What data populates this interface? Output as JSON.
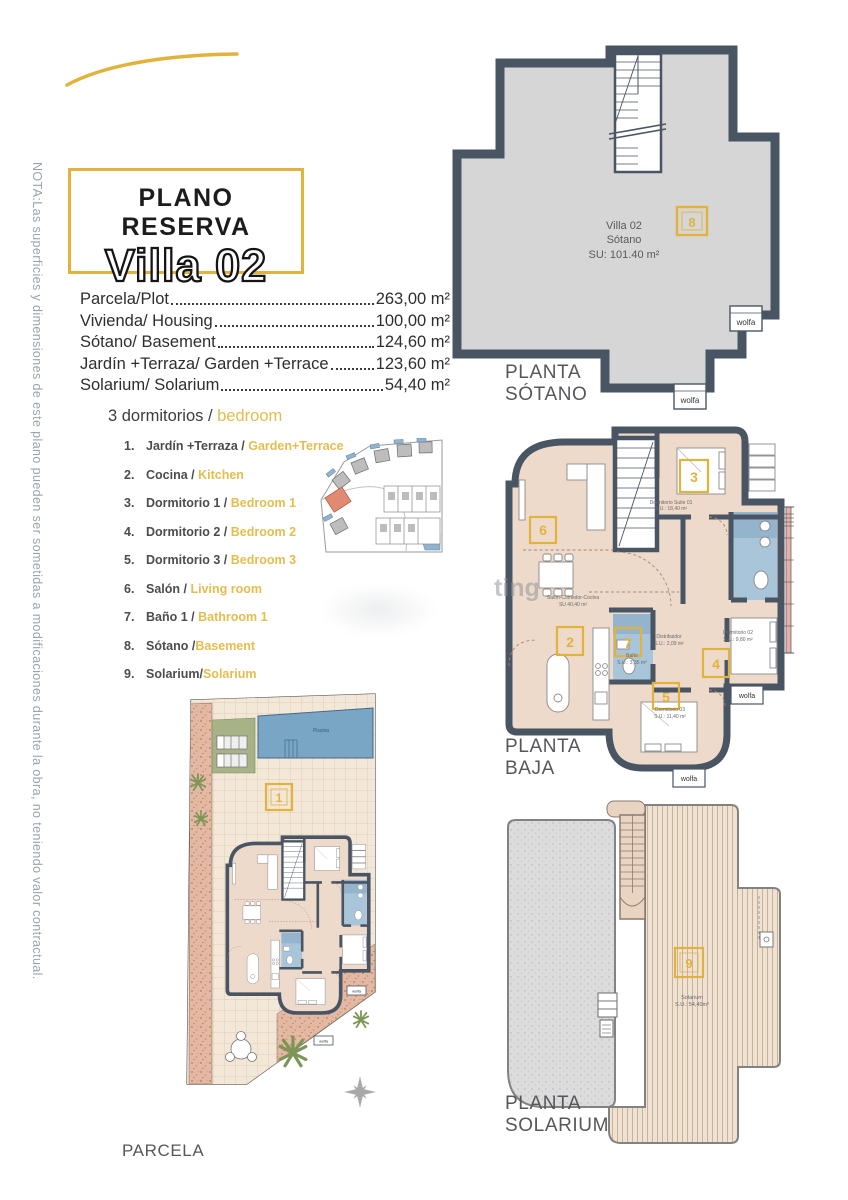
{
  "note": "NOTA:Las superficies y dimensiones de este plano pueden ser sometidas a modificaciones durante la obra, no teniendo valor contractual.",
  "title": {
    "kicker": "PLANO RESERVA",
    "name": "Villa 02"
  },
  "areas": [
    {
      "label": "Parcela/Plot",
      "value": "263,00 m²"
    },
    {
      "label": "Vivienda/ Housing",
      "value": "100,00 m²"
    },
    {
      "label": "Sótano/ Basement",
      "value": "124,60 m²"
    },
    {
      "label": "Jardín +Terraza/ Garden +Terrace",
      "value": "123,60 m²"
    },
    {
      "label": "Solarium/ Solarium",
      "value": "54,40 m²"
    }
  ],
  "legend": {
    "header": {
      "es": "3 dormitorios / ",
      "en": "bedroom"
    },
    "items": [
      {
        "n": "1.",
        "es": "Jardín +Terraza / ",
        "en": "Garden+Terrace"
      },
      {
        "n": "2.",
        "es": "Cocina / ",
        "en": "Kitchen"
      },
      {
        "n": "3.",
        "es": "Dormitorio 1 / ",
        "en": "Bedroom 1"
      },
      {
        "n": "4.",
        "es": "Dormitorio 2 / ",
        "en": "Bedroom 2"
      },
      {
        "n": "5.",
        "es": "Dormitorio 3 / ",
        "en": "Bedroom 3"
      },
      {
        "n": "6.",
        "es": "Salón / ",
        "en": "Living room"
      },
      {
        "n": "7.",
        "es": "Baño 1 / ",
        "en": "Bathroom 1"
      },
      {
        "n": "8.",
        "es": "Sótano /",
        "en": "Basement"
      },
      {
        "n": "9.",
        "es": "Solarium/",
        "en": "Solarium"
      }
    ]
  },
  "plans": {
    "sotano": {
      "caption_l1": "PLANTA",
      "caption_l2": "SÓTANO",
      "unit": "Villa 02",
      "room": "Sótano",
      "area": "SU: 101.40 m²",
      "number": "8",
      "wolfa": "wolfa"
    },
    "baja": {
      "caption_l1": "PLANTA",
      "caption_l2": "BAJA",
      "wolfa": "wolfa",
      "rooms": {
        "salon": {
          "name": "Salón-Comedor-Cocina",
          "area": "SU 40,40 m²",
          "number": "6"
        },
        "cocina_number": "2",
        "suite": {
          "name": "Dormitorio Suite 01",
          "area": "S.U.: 18,40 m²",
          "number": "3"
        },
        "distribuidor": {
          "name": "Distribuidor",
          "area": "S.U.: 2,09 m²"
        },
        "bano": {
          "name": "Baño",
          "area": "S.U.: 3,35 m²",
          "number": "7"
        },
        "dorm2": {
          "name": "Dormitorio 02",
          "area": "S.U.: 9,80 m²",
          "number": "4"
        },
        "dorm3": {
          "name": "Dormitorio 03",
          "area": "S.U.: 11,40 m²",
          "number": "5"
        }
      }
    },
    "parcela": {
      "caption": "PARCELA",
      "pool": "Piscina",
      "number": "1",
      "wolfa": "wolfa"
    },
    "solarium": {
      "caption_l1": "PLANTA",
      "caption_l2": "SOLARIUM",
      "room": "Solarium",
      "area": "S.U.: 54,40m²",
      "number": "9"
    }
  },
  "watermark": "ting",
  "colors": {
    "accent": "#e2b33c",
    "wall": "#4a5564",
    "basement_fill": "#d6d6d6",
    "room_beige": "#eddacb",
    "bath_blue": "#a9c5da",
    "pool_blue": "#7aa6c6",
    "lawn_green": "#a8b287",
    "gravel": "#e3b9a4",
    "highlight_plot": "#e08a74"
  }
}
